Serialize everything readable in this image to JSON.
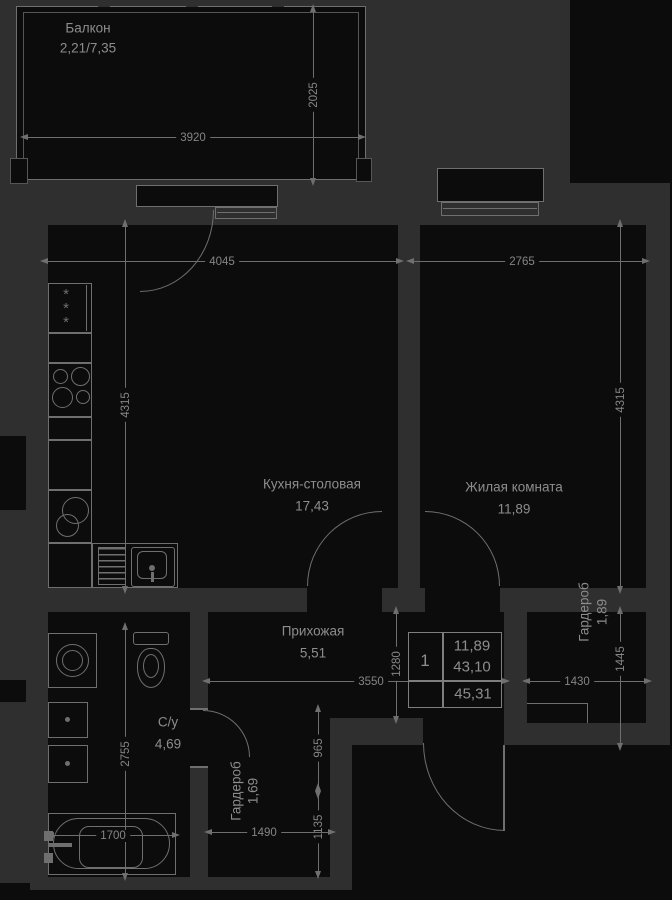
{
  "balcony": {
    "label": "Балкон",
    "area": "2,21/7,35"
  },
  "rooms": {
    "kitchen": {
      "label": "Кухня-столовая",
      "area": "17,43"
    },
    "living": {
      "label": "Жилая комната",
      "area": "11,89"
    },
    "hall": {
      "label": "Прихожая",
      "area": "5,51"
    },
    "bath": {
      "label": "С/у",
      "area": "4,69"
    },
    "wardrobe_small": {
      "label": "Гардероб",
      "area": "1,69"
    },
    "wardrobe_big": {
      "label": "Гардероб",
      "area": "1,89"
    }
  },
  "dims": {
    "balcony_width": "3920",
    "balcony_depth": "2025",
    "kitchen_width": "4045",
    "living_width": "2765",
    "kitchen_height": "4315",
    "living_height": "4315",
    "hall_height": "1280",
    "hall_width": "3550",
    "wardrobe_big_width": "1430",
    "wardrobe_big_height": "1445",
    "bath_height": "2755",
    "lobby_height": "965",
    "wardrobe_small_height": "1135",
    "wardrobe_small_width": "1490",
    "bath_width": "1700"
  },
  "info_table": {
    "rooms": "1",
    "living_area": "11,89",
    "area": "43,10",
    "total_area": "45,31"
  },
  "fridge_stars": "*\n*\n*",
  "colors": {
    "wall": "#2f2f2f",
    "floor": "#0c0c0c",
    "line": "#6f6f6f",
    "text": "#8d8d8d"
  }
}
